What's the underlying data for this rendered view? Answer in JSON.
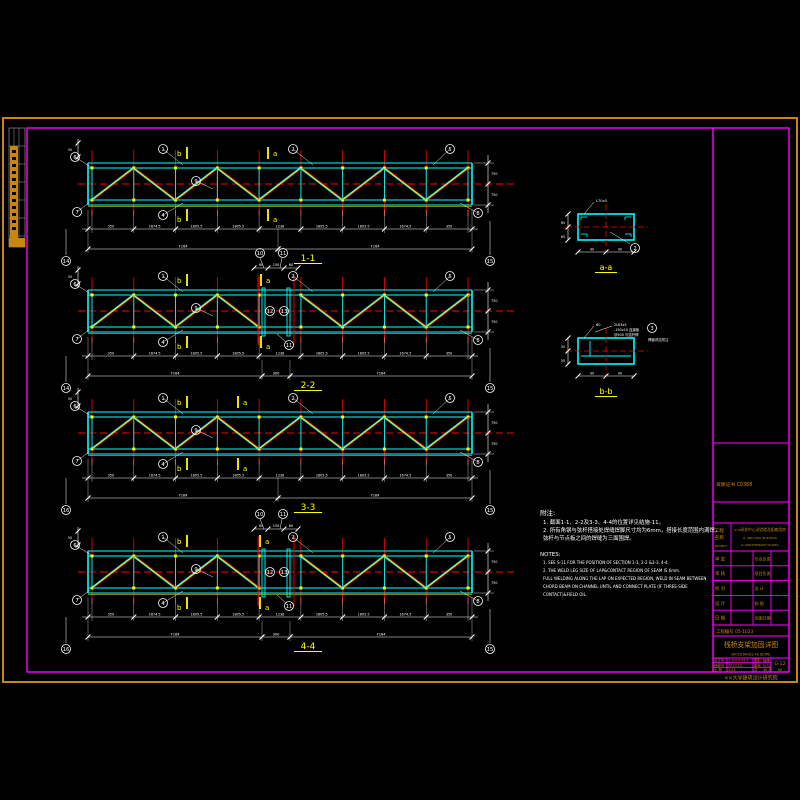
{
  "colors": {
    "background": "#000000",
    "outer_frame": "#c8860a",
    "inner_frame": "#ff00ff",
    "chord": "#00ffff",
    "diagonal": "#ffff00",
    "grid_axis": "#ff0000",
    "dimension": "#ffffff",
    "section_label": "#ffff00",
    "titleblock_text": "#c8860a"
  },
  "trusses": [
    {
      "label": "1-1",
      "x0": 88,
      "x1": 472,
      "top": 163,
      "marker_a_x": 270,
      "splice": false,
      "left_no": "14",
      "right_no": "15",
      "dims1": [
        "350",
        "1674.5",
        "1805.5",
        "1805.5",
        "1238",
        "1805.5",
        "1805.5",
        "1674.5",
        "350"
      ],
      "totals": [
        "7164",
        "7164"
      ]
    },
    {
      "label": "2-2",
      "x0": 88,
      "x1": 472,
      "top": 290,
      "marker_a_x": 263,
      "splice": true,
      "left_no": "14",
      "right_no": "15",
      "dims1": [
        "350",
        "1674.5",
        "1805.5",
        "1805.5",
        "1238",
        "1805.5",
        "1805.5",
        "1674.5",
        "350"
      ],
      "totals": [
        "7164",
        "7164"
      ]
    },
    {
      "label": "3-3",
      "x0": 88,
      "x1": 472,
      "top": 412,
      "marker_a_x": 240,
      "splice": false,
      "left_no": "16",
      "right_no": "15",
      "dims1": [
        "350",
        "1674.5",
        "1805.5",
        "1805.5",
        "1238",
        "1805.5",
        "1805.5",
        "1674.5",
        "350"
      ],
      "totals": [
        "7164",
        "7164"
      ]
    },
    {
      "label": "4-4",
      "x0": 88,
      "x1": 472,
      "top": 551,
      "marker_a_x": 262,
      "splice": true,
      "left_no": "16",
      "right_no": "15",
      "dims1": [
        "350",
        "1674.5",
        "1805.5",
        "1805.5",
        "1238",
        "1805.5",
        "1805.5",
        "1674.5",
        "350"
      ],
      "totals": [
        "7164",
        "7164"
      ]
    }
  ],
  "truss_common": {
    "marker_b": "b",
    "marker_a": "a",
    "panel_count": 9,
    "end_dim_labels": [
      "750",
      "750"
    ],
    "micro_dim": "50",
    "splice_dims": [
      "60",
      "150",
      "60"
    ],
    "splice_total": "300",
    "callouts": [
      {
        "n": "6",
        "dx": -13,
        "dy": -6,
        "tx": 3,
        "ty": 4
      },
      {
        "n": "7",
        "dx": -11,
        "dy": 49,
        "tx": 2,
        "ty": 39
      },
      {
        "n": "1",
        "dx": 75,
        "dy": -14,
        "tx": 95,
        "ty": 2
      },
      {
        "n": "4",
        "dx": 75,
        "dy": 52,
        "tx": 95,
        "ty": 40
      },
      {
        "n": "9",
        "dx": 108,
        "dy": 18,
        "tx": 125,
        "ty": 26
      },
      {
        "n": "2",
        "dx": 205,
        "dy": -14,
        "tx": 225,
        "ty": 2
      },
      {
        "n": "5",
        "dx": 362,
        "dy": -14,
        "tx": 345,
        "ty": 2
      },
      {
        "n": "8",
        "dx": 390,
        "dy": 50,
        "tx": 372,
        "ty": 40
      }
    ],
    "splice_callouts_top": [
      "10",
      "11"
    ],
    "splice_callouts_mid": [
      "12",
      "13"
    ],
    "splice_callout_bottom": "11"
  },
  "sections": {
    "a": {
      "label": "a-a",
      "x": 578,
      "y": 214,
      "w": 56,
      "h": 26,
      "dim_left": [
        "65",
        "65"
      ],
      "dim_bottom": [
        "90",
        "90"
      ],
      "leader_top": "L70x5",
      "callout": "2"
    },
    "b": {
      "label": "b-b",
      "x": 578,
      "y": 338,
      "w": 56,
      "h": 26,
      "dim_left": [
        "55",
        "55"
      ],
      "dim_bottom": [
        "90",
        "90"
      ],
      "leader_top": "60",
      "ann_lines": [
        "2L63x5",
        "-150x10 连接板",
        "@500 与弦杆焊"
      ],
      "callout": "3",
      "side_note": "焊缝详见附注"
    }
  },
  "notes": {
    "cn_title": "附注:",
    "cn_lines": [
      "1. 截面1-1、2-2及3-3、4-4的位置详见结施-11。",
      "2. 所有角钢与弦杆搭接处焊缝焊脚尺寸均为6mm，搭接长度范围内满焊，",
      "   弦杆与节点板之间的焊缝为三面围焊。"
    ],
    "en_title": "NOTES:",
    "en_lines": [
      "1. SEE S-11 FOR THE POSITION OF SECTION 1-1, 2-2 &3-3, 4-4.",
      "2. THE WELD LEG SIZE OF LAP&CONTACT REGION OF SEAM IS 6mm.",
      "   FULL WELDING ALONG THE LAP ON EXPECTED REGION, WELD IN SEAM BETWEEN",
      "   CHORD BEAM ON CHANNEL UNTIL AND CONNECT PLATE (IF THREE-SIDE",
      "   CONTACT)&FIELD OIL."
    ]
  },
  "title_block": {
    "cert": "资质证书 C0368",
    "project_label_cn": "工程名称",
    "project_label_en": "PROJECT",
    "project_name_cn": "××研发中心试验楼及配套用房",
    "project_name_en1": "R. AND DEV. BUILDING",
    "project_name_en2": "& APPURTENANT WORKS",
    "sign_rows": [
      {
        "l": "审 定",
        "r": "专业负责"
      },
      {
        "l": "审 核",
        "r": "项目负责"
      },
      {
        "l": "校 对",
        "r": "设 计"
      },
      {
        "l": "设 计",
        "r": "制 图"
      },
      {
        "l": "日 期",
        "r": "出图日期"
      }
    ],
    "project_no_label": "工程编号",
    "project_no": "05-1023",
    "title_cn": "栈桥支架加固详图",
    "title_en": "CROSS RACKS XX DETAIL",
    "grid": [
      [
        "设计号",
        "2-2010-05/1",
        "图别",
        "结施"
      ],
      [
        "档案号",
        "2010.12",
        "图号",
        "G-12"
      ],
      [
        "比 例",
        "1:25",
        "共",
        "40 张"
      ]
    ],
    "fig_no": "G-12",
    "sheet_no": "40",
    "institute": "××大学建筑设计研究院"
  }
}
